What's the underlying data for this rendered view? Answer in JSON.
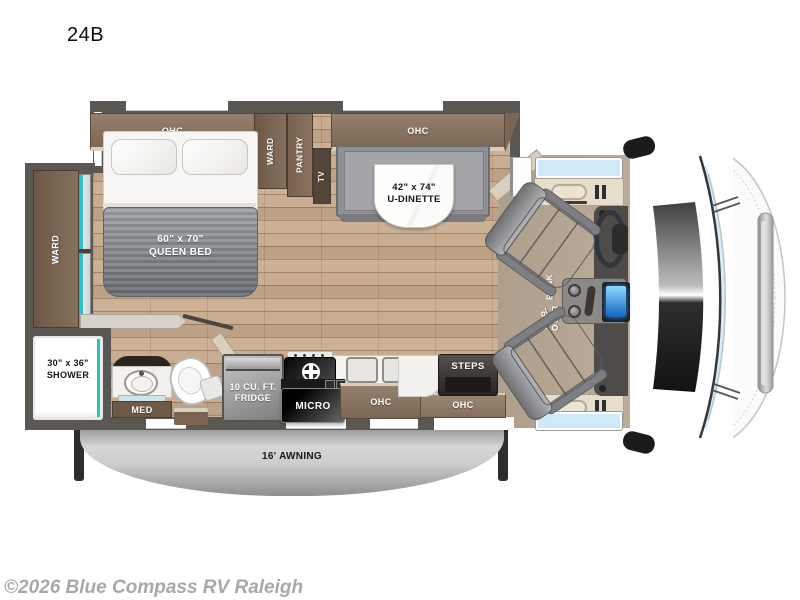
{
  "title": "24B",
  "copyright": "©2026 Blue Compass RV Raleigh",
  "plan": {
    "upper_cabinets": {
      "ohc_left": "OHC",
      "ward": "WARD",
      "pantry": "PANTRY",
      "tv": "TV",
      "ohc_right": "OHC"
    },
    "bedroom": {
      "bed_size": "60\" x 70\"",
      "bed_name": "QUEEN BED",
      "side_ward": "WARD"
    },
    "dinette": {
      "size": "42\" x 74\"",
      "name": "U-DINETTE"
    },
    "bathroom": {
      "shower_size": "30\" x 36\"",
      "shower_name": "SHOWER",
      "med": "MED"
    },
    "kitchen": {
      "fridge_line1": "10 CU. FT.",
      "fridge_line2": "FRIDGE",
      "micro": "MICRO",
      "ohc": "OHC"
    },
    "entry": {
      "steps": "STEPS",
      "ohc": "OHC"
    },
    "cab": {
      "bunk_line1": "CAB-OVER",
      "bunk_line2": "BUNK"
    },
    "awning_label": "16' AWNING",
    "colors": {
      "wall": "#5b5753",
      "cabinet_wood": "#86705c",
      "cabinet_dark": "#6e5947",
      "floor_wood": "#c8ab8f",
      "accent_teal": "#28c4cc",
      "cab_carpet": "#b7a693",
      "screen_blue": "#2a7fd4",
      "awning_silver": "#c0c0c0"
    }
  }
}
